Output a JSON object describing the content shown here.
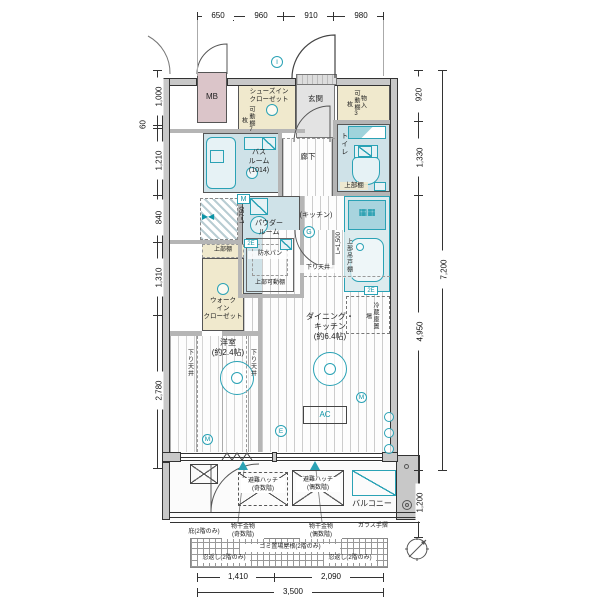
{
  "colors": {
    "teal": "#2aa2b5",
    "wet_blue": "#cfe2e8",
    "closet_beige": "#f0e9cd",
    "mb_pink": "#dbc5c9",
    "wall_gray": "#c8c8c8",
    "entry_gray": "#e3e3e3"
  },
  "rooms": {
    "mb": "MB",
    "shoes_in_closet": "シューズイン\nクローゼット",
    "entrance": "玄関",
    "storage": "物入",
    "toilet": "トイレ",
    "bathroom": "バス\nルーム\n(1014)",
    "hallway": "廊下",
    "powder_room": "パウダー\nルーム",
    "kitchen": "(キッチン)",
    "walk_in_closet": "ウォーク\nイン\nクローゼット",
    "dining_kitchen": "ダイニング・\nキッチン\n(約6.4帖)",
    "western_room": "洋室\n(約2.4帖)",
    "balcony": "バルコニー"
  },
  "notes": {
    "movable_shelf_7": "可動棚7枚",
    "movable_shelf_3": "可動棚3枚",
    "upper_shelf_wic": "上部棚",
    "upper_shelf_toilet": "上部棚",
    "upper_hanging_cupboard": "上部吊戸棚",
    "upper_movable_shelf": "上部可動棚",
    "waterproof_pan": "防水パン",
    "washer_l750": "L=750",
    "kitchen_l1500": "L=1,500",
    "fridge_space": "冷蔵庫置場",
    "lowered_ceiling": "下り天井",
    "ac": "AC",
    "evac_hatch_odd": "避難ハッチ\n(奇数階)",
    "evac_hatch_even": "避難ハッチ\n(偶数階)",
    "laundry_fitting_odd": "物干金物\n(奇数階)",
    "laundry_fitting_even": "物干金物\n(偶数階)",
    "glass_handrail": "ガラス手摺",
    "eaves_2f": "庇(2階のみ)",
    "garbage_roof_2f": "ゴミ置場屋根(2階のみ)",
    "spikes_left": "忍返し(2階のみ)",
    "spikes_right": "忍返し(2階のみ)"
  },
  "symbols": {
    "entrance_i": "I",
    "meter_m_box": "M",
    "kitchen_g": "G",
    "western_m": "M",
    "dk_e": "E",
    "wall_m": "M",
    "outlet_2e_washer": "2E",
    "outlet_2e_fridge": "2E"
  },
  "dims": {
    "top": [
      "650",
      "960",
      "910",
      "980"
    ],
    "left": [
      "1,000",
      "60",
      "1,210",
      "840",
      "1,310",
      "2,780"
    ],
    "right": [
      "920",
      "1,330",
      "4,950",
      "7,200",
      "1,200"
    ],
    "bottom": [
      "1,410",
      "2,090",
      "3,500"
    ]
  }
}
